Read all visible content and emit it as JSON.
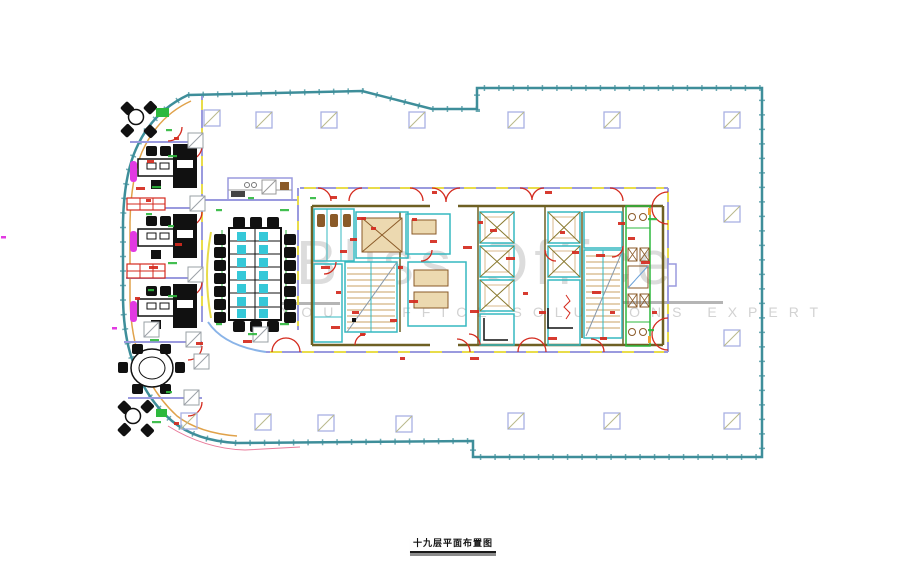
{
  "window": {
    "background": "#ffffff",
    "width": 906,
    "height": 571
  },
  "watermark": {
    "brand": "Bliss Office",
    "tagline": "YOUR OFFICE SOLUTIONS EXPERT",
    "brand_color": "#dcdcdc",
    "tagline_color": "#d2d2d2",
    "rule_color": "#b5b5b5"
  },
  "title_block": {
    "text": "十九层平面布置图",
    "color": "#111111"
  },
  "palette": {
    "outer_wall": "#3e8e9a",
    "inner_face": "#e0a24a",
    "partition": "#9a9ade",
    "door": "#d42a1e",
    "dimension": "#2db83d",
    "core_room": "#35b8c0",
    "core_wall": "#6e6023",
    "fixture": "#8a5a28",
    "stair_tread": "#c9a063",
    "furniture": "#111111",
    "accent_magenta": "#e23ae2",
    "accent_yellow": "#e8dc4a",
    "column": "#a9b1e3",
    "lobby_glass": "#8ab4e8"
  },
  "plan": {
    "columns": [
      [
        256,
        112
      ],
      [
        321,
        112
      ],
      [
        409,
        112
      ],
      [
        508,
        112
      ],
      [
        604,
        112
      ],
      [
        724,
        112
      ],
      [
        204,
        110
      ],
      [
        724,
        206
      ],
      [
        724,
        330
      ],
      [
        181,
        413
      ],
      [
        255,
        414
      ],
      [
        318,
        415
      ],
      [
        396,
        416
      ],
      [
        508,
        413
      ],
      [
        604,
        413
      ],
      [
        724,
        413
      ]
    ],
    "partition_columns": [
      [
        188,
        133
      ],
      [
        190,
        196
      ],
      [
        188,
        267
      ],
      [
        186,
        332
      ],
      [
        184,
        390
      ],
      [
        253,
        327
      ],
      [
        194,
        354
      ],
      [
        144,
        322
      ]
    ],
    "red_labels": [
      [
        174,
        137
      ],
      [
        147,
        160
      ],
      [
        136,
        187
      ],
      [
        146,
        199
      ],
      [
        175,
        243
      ],
      [
        149,
        266
      ],
      [
        135,
        297
      ],
      [
        196,
        342
      ],
      [
        243,
        340
      ],
      [
        174,
        422
      ],
      [
        330,
        196
      ],
      [
        357,
        217
      ],
      [
        371,
        227
      ],
      [
        340,
        250
      ],
      [
        321,
        266
      ],
      [
        336,
        291
      ],
      [
        352,
        311
      ],
      [
        331,
        326
      ],
      [
        360,
        333
      ],
      [
        390,
        319
      ],
      [
        409,
        300
      ],
      [
        398,
        266
      ],
      [
        430,
        240
      ],
      [
        463,
        246
      ],
      [
        478,
        221
      ],
      [
        490,
        229
      ],
      [
        506,
        257
      ],
      [
        523,
        292
      ],
      [
        539,
        311
      ],
      [
        470,
        310
      ],
      [
        560,
        231
      ],
      [
        572,
        251
      ],
      [
        592,
        291
      ],
      [
        610,
        311
      ],
      [
        628,
        237
      ],
      [
        641,
        261
      ],
      [
        652,
        311
      ],
      [
        600,
        337
      ],
      [
        548,
        337
      ],
      [
        432,
        191
      ],
      [
        545,
        191
      ],
      [
        470,
        357
      ],
      [
        400,
        357
      ],
      [
        618,
        222
      ],
      [
        596,
        254
      ],
      [
        412,
        218
      ],
      [
        350,
        238
      ]
    ],
    "green_labels": [
      [
        166,
        129
      ],
      [
        152,
        186
      ],
      [
        146,
        213
      ],
      [
        168,
        262
      ],
      [
        148,
        289
      ],
      [
        150,
        339
      ],
      [
        166,
        391
      ],
      [
        152,
        421
      ],
      [
        216,
        209
      ],
      [
        280,
        209
      ],
      [
        216,
        323
      ],
      [
        280,
        323
      ],
      [
        248,
        197
      ],
      [
        248,
        333
      ],
      [
        310,
        197
      ],
      [
        648,
        218
      ],
      [
        648,
        329
      ],
      [
        168,
        155
      ],
      [
        168,
        225
      ],
      [
        168,
        295
      ]
    ],
    "magenta_marks": [
      [
        1,
        236
      ],
      [
        112,
        327
      ]
    ]
  }
}
